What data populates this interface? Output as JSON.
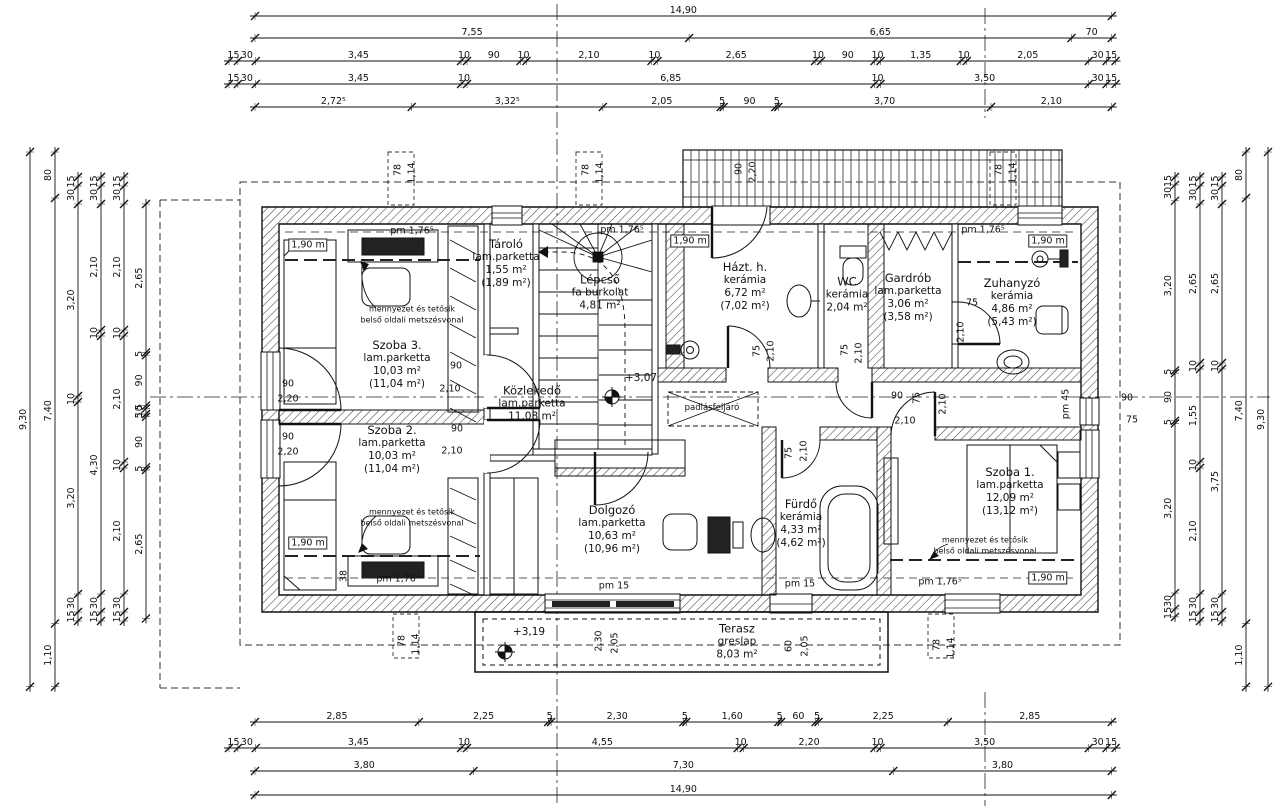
{
  "drawing": {
    "kind": "floor-plan",
    "language": "hu",
    "line_color": "#1a1a1a",
    "background": "#ffffff",
    "level_marks": [
      "+3,07",
      "+3,19"
    ]
  },
  "rooms": [
    {
      "cx": 506,
      "cy": 264,
      "lines": [
        "Tároló",
        "lam.parketta",
        "1,55 m²",
        "(1,89 m²)"
      ]
    },
    {
      "cx": 600,
      "cy": 293,
      "lines": [
        "Lépcső",
        "fa burkolat",
        "4,81 m²"
      ]
    },
    {
      "cx": 745,
      "cy": 287,
      "lines": [
        "Házt. h.",
        "kerámia",
        "6,72 m²",
        "(7,02 m²)"
      ]
    },
    {
      "cx": 847,
      "cy": 295,
      "lines": [
        "WC",
        "kerámia",
        "2,04 m²"
      ]
    },
    {
      "cx": 908,
      "cy": 298,
      "lines": [
        "Gardrób",
        "lam.parketta",
        "3,06 m²",
        "(3,58 m²)"
      ]
    },
    {
      "cx": 1012,
      "cy": 303,
      "lines": [
        "Zuhanyzó",
        "kerámia",
        "4,86 m²",
        "(5,43 m²)"
      ]
    },
    {
      "cx": 397,
      "cy": 365,
      "lines": [
        "Szoba 3.",
        "lam.parketta",
        "10,03 m²",
        "(11,04 m²)"
      ]
    },
    {
      "cx": 532,
      "cy": 404,
      "lines": [
        "Közlekedő",
        "lam.parketta",
        "11,08 m²"
      ]
    },
    {
      "cx": 392,
      "cy": 450,
      "lines": [
        "Szoba 2.",
        "lam.parketta",
        "10,03 m²",
        "(11,04 m²)"
      ]
    },
    {
      "cx": 612,
      "cy": 530,
      "lines": [
        "Dolgozó",
        "lam.parketta",
        "10,63 m²",
        "(10,96 m²)"
      ]
    },
    {
      "cx": 801,
      "cy": 524,
      "lines": [
        "Fürdő",
        "kerámia",
        "4,33 m²",
        "(4,62 m²)"
      ]
    },
    {
      "cx": 1010,
      "cy": 492,
      "lines": [
        "Szoba 1.",
        "lam.parketta",
        "12,09 m²",
        "(13,12 m²)"
      ]
    },
    {
      "cx": 737,
      "cy": 642,
      "lines": [
        "Terasz",
        "greslap",
        "8,03 m²"
      ]
    }
  ],
  "rulers": {
    "horizontal": [
      {
        "y": 16,
        "x0": 255,
        "scale": 57.5,
        "segs": [
          "14,90"
        ]
      },
      {
        "y": 38,
        "x0": 255,
        "scale": 57.5,
        "segs": [
          "7,55",
          "6,65",
          "70"
        ]
      },
      {
        "y": 61,
        "x0": 229,
        "scale": 59.5,
        "segs": [
          "15",
          "30",
          "3,45",
          "10",
          "90",
          "10",
          "2,10",
          "10",
          "2,65",
          "10",
          "90",
          "10",
          "1,35",
          "10",
          "2,05",
          "30",
          "15"
        ]
      },
      {
        "y": 84,
        "x0": 229,
        "scale": 59.5,
        "segs": [
          "15",
          "30",
          "3,45",
          "10",
          "6,85",
          "10",
          "3,50",
          "30",
          "15"
        ]
      },
      {
        "y": 107,
        "x0": 255,
        "scale": 57.5,
        "segs": [
          "2,72⁵",
          "3,32⁵",
          "2,05",
          "5",
          "90",
          "5",
          "3,70",
          "2,10"
        ]
      },
      {
        "y": 722,
        "x0": 255,
        "scale": 57.5,
        "segs": [
          "2,85",
          "2,25",
          "5",
          "2,30",
          "5",
          "1,60",
          "5",
          "60",
          "5",
          "2,25",
          "2,85"
        ]
      },
      {
        "y": 748,
        "x0": 229,
        "scale": 59.5,
        "segs": [
          "15",
          "30",
          "3,45",
          "10",
          "4,55",
          "10",
          "2,20",
          "10",
          "3,50",
          "30",
          "15"
        ]
      },
      {
        "y": 771,
        "x0": 255,
        "scale": 57.5,
        "segs": [
          "3,80",
          "7,30",
          "3,80"
        ]
      },
      {
        "y": 795,
        "x0": 255,
        "scale": 57.5,
        "segs": [
          "14,90"
        ]
      }
    ],
    "vertical": [
      {
        "x": 30,
        "y0": 152,
        "scale": 57.5,
        "segs": [
          "9,30"
        ]
      },
      {
        "x": 55,
        "y0": 152,
        "scale": 57.5,
        "segs": [
          "80",
          "7,40",
          "1,10"
        ]
      },
      {
        "x": 78,
        "y0": 177,
        "scale": 60,
        "segs": [
          "15",
          "30",
          "3,20",
          "10",
          "3,20",
          "30",
          "15"
        ]
      },
      {
        "x": 101,
        "y0": 177,
        "scale": 60,
        "segs": [
          "15",
          "30",
          "2,10",
          "10",
          "4,30",
          "30",
          "15"
        ]
      },
      {
        "x": 124,
        "y0": 177,
        "scale": 60,
        "segs": [
          "15",
          "30",
          "2,10",
          "10",
          "2,10",
          "10",
          "2,10",
          "30",
          "15"
        ]
      },
      {
        "x": 146,
        "y0": 204,
        "scale": 56,
        "segs": [
          "2,65",
          "5",
          "90",
          "5",
          "10",
          "5",
          "90",
          "5",
          "2,65"
        ]
      },
      {
        "x": 1175,
        "y0": 177,
        "scale": 53,
        "segs": [
          "15",
          "30",
          "3,20",
          "5",
          "90",
          "5",
          "3,20",
          "30",
          "15"
        ]
      },
      {
        "x": 1200,
        "y0": 177,
        "scale": 60,
        "segs": [
          "15",
          "30",
          "2,65",
          "10",
          "1,55",
          "10",
          "2,10",
          "30",
          "15"
        ]
      },
      {
        "x": 1222,
        "y0": 177,
        "scale": 60,
        "segs": [
          "15",
          "30",
          "2,65",
          "10",
          "3,75",
          "30",
          "15"
        ]
      },
      {
        "x": 1246,
        "y0": 152,
        "scale": 57.5,
        "segs": [
          "80",
          "7,40",
          "1,10"
        ]
      },
      {
        "x": 1268,
        "y0": 152,
        "scale": 57.5,
        "segs": [
          "9,30"
        ]
      }
    ]
  },
  "plan_labels": [
    {
      "t": "90",
      "x": 288,
      "y": 384
    },
    {
      "t": "2,20",
      "x": 288,
      "y": 399
    },
    {
      "t": "90",
      "x": 288,
      "y": 437
    },
    {
      "t": "2,20",
      "x": 288,
      "y": 452
    },
    {
      "t": "90",
      "x": 456,
      "y": 366
    },
    {
      "t": "2,10",
      "x": 450,
      "y": 389
    },
    {
      "t": "90",
      "x": 457,
      "y": 429
    },
    {
      "t": "2,10",
      "x": 452,
      "y": 451
    },
    {
      "t": "75",
      "x": 757,
      "y": 351,
      "r": 1
    },
    {
      "t": "2,10",
      "x": 771,
      "y": 351,
      "r": 1
    },
    {
      "t": "75",
      "x": 845,
      "y": 350,
      "r": 1
    },
    {
      "t": "2,10",
      "x": 859,
      "y": 353,
      "r": 1
    },
    {
      "t": "75",
      "x": 972,
      "y": 303
    },
    {
      "t": "2,10",
      "x": 961,
      "y": 332,
      "r": 1
    },
    {
      "t": "90",
      "x": 897,
      "y": 396
    },
    {
      "t": "75",
      "x": 917,
      "y": 398,
      "r": 1
    },
    {
      "t": "2,10",
      "x": 943,
      "y": 404,
      "r": 1
    },
    {
      "t": "2,10",
      "x": 905,
      "y": 421
    },
    {
      "t": "75",
      "x": 789,
      "y": 453,
      "r": 1
    },
    {
      "t": "2,10",
      "x": 804,
      "y": 451,
      "r": 1
    },
    {
      "t": "90",
      "x": 1127,
      "y": 398
    },
    {
      "t": "75",
      "x": 1132,
      "y": 420
    },
    {
      "t": "90",
      "x": 739,
      "y": 169,
      "r": 1
    },
    {
      "t": "2,20",
      "x": 753,
      "y": 172,
      "r": 1
    },
    {
      "t": "78",
      "x": 398,
      "y": 170,
      "r": 1
    },
    {
      "t": "1,14",
      "x": 412,
      "y": 173,
      "r": 1
    },
    {
      "t": "78",
      "x": 586,
      "y": 170,
      "r": 1
    },
    {
      "t": "1,14",
      "x": 600,
      "y": 173,
      "r": 1
    },
    {
      "t": "78",
      "x": 999,
      "y": 170,
      "r": 1
    },
    {
      "t": "1,14",
      "x": 1013,
      "y": 173,
      "r": 1
    },
    {
      "t": "78",
      "x": 402,
      "y": 641,
      "r": 1
    },
    {
      "t": "1,14",
      "x": 416,
      "y": 644,
      "r": 1
    },
    {
      "t": "78",
      "x": 937,
      "y": 645,
      "r": 1
    },
    {
      "t": "1,14",
      "x": 951,
      "y": 648,
      "r": 1
    },
    {
      "t": "2,30",
      "x": 599,
      "y": 641,
      "r": 1
    },
    {
      "t": "2,05",
      "x": 615,
      "y": 643,
      "r": 1
    },
    {
      "t": "60",
      "x": 789,
      "y": 646,
      "r": 1
    },
    {
      "t": "2,05",
      "x": 805,
      "y": 646,
      "r": 1
    },
    {
      "t": "38",
      "x": 344,
      "y": 576,
      "r": 1
    },
    {
      "t": "pm 1,76⁵",
      "x": 412,
      "y": 231
    },
    {
      "t": "pm 1,76⁵",
      "x": 622,
      "y": 230
    },
    {
      "t": "pm 1,76⁵",
      "x": 983,
      "y": 230
    },
    {
      "t": "pm 1,76⁵",
      "x": 398,
      "y": 579
    },
    {
      "t": "pm 1,76⁵",
      "x": 940,
      "y": 582
    },
    {
      "t": "pm 15",
      "x": 614,
      "y": 586
    },
    {
      "t": "pm 15",
      "x": 800,
      "y": 584
    },
    {
      "t": "pm 45",
      "x": 1066,
      "y": 404,
      "r": 1
    },
    {
      "t": "1,90 m",
      "x": 308,
      "y": 245,
      "box": 1
    },
    {
      "t": "1,90 m",
      "x": 690,
      "y": 241,
      "box": 1
    },
    {
      "t": "1,90 m",
      "x": 1048,
      "y": 241,
      "box": 1
    },
    {
      "t": "1,90 m",
      "x": 308,
      "y": 543,
      "box": 1
    },
    {
      "t": "1,90 m",
      "x": 1048,
      "y": 578,
      "box": 1
    },
    {
      "t": "+3,07",
      "x": 641,
      "y": 378,
      "s": 10.5
    },
    {
      "t": "+3,19",
      "x": 529,
      "y": 632,
      "s": 10.5
    },
    {
      "t": "mennyezet és tetősík",
      "x": 412,
      "y": 309,
      "s": 8
    },
    {
      "t": "belső oldali metszésvonal",
      "x": 412,
      "y": 320,
      "s": 8
    },
    {
      "t": "mennyezet és tetősík",
      "x": 412,
      "y": 512,
      "s": 8
    },
    {
      "t": "belső oldali metszésvonal",
      "x": 412,
      "y": 523,
      "s": 8
    },
    {
      "t": "mennyezet és tetősík",
      "x": 985,
      "y": 540,
      "s": 8
    },
    {
      "t": "belső oldali metszésvonal",
      "x": 985,
      "y": 551,
      "s": 8
    },
    {
      "t": "padlásfeljáró",
      "x": 712,
      "y": 408,
      "s": 8.5
    }
  ]
}
